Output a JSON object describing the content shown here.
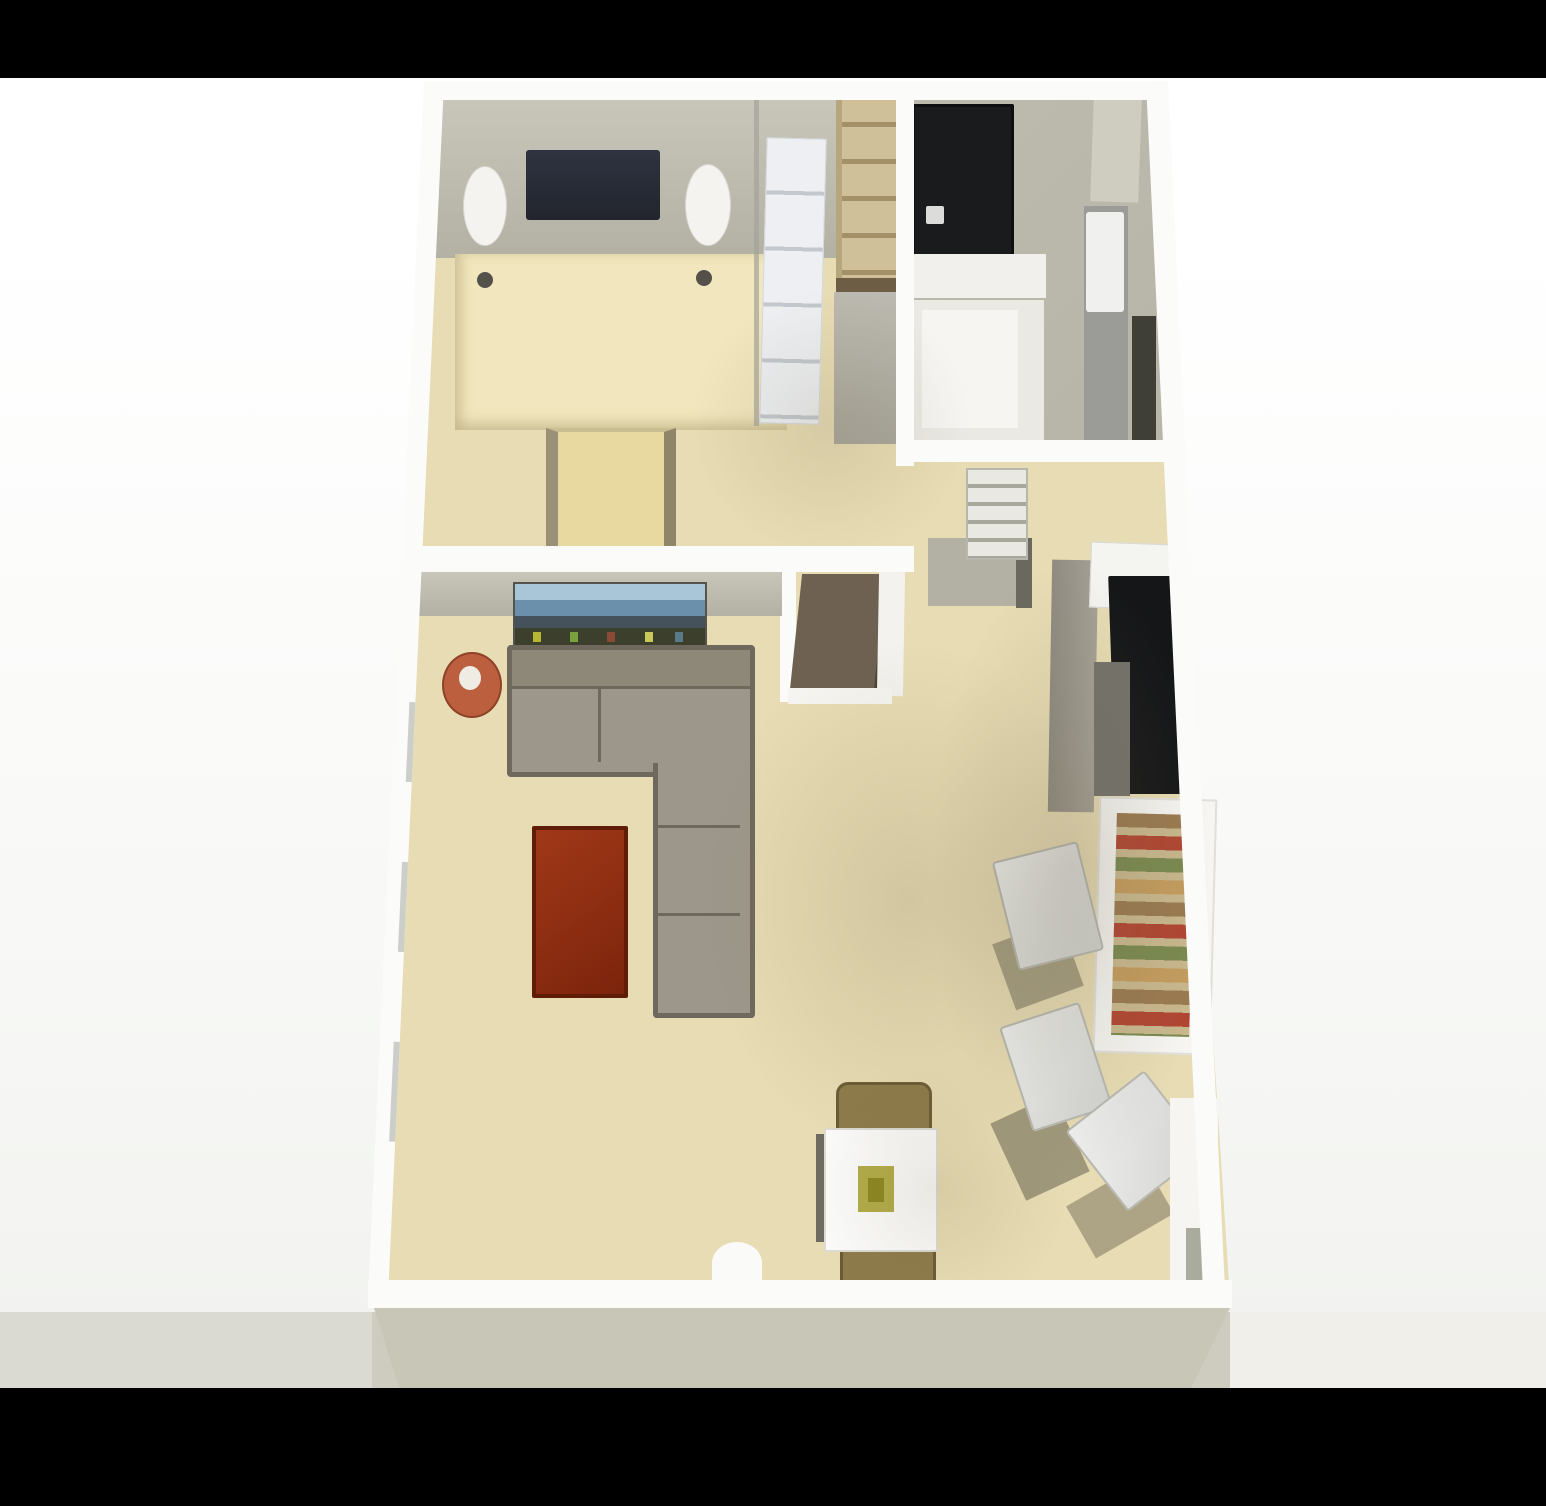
{
  "scene": {
    "type": "3D rendered apartment floor plan, top-down view, letterboxed photo",
    "letterbox": {
      "top_bar": "black",
      "bottom_bar": "black"
    },
    "rooms": [
      {
        "name": "bedroom",
        "position": "top-left",
        "furniture": [
          "bed with dark navy headboard",
          "left white nightstand",
          "right white nightstand",
          "tan bed cover with two dark pillows",
          "bench at foot of bed"
        ]
      },
      {
        "name": "closet",
        "position": "top-center",
        "furniture": [
          "white shelving tower",
          "tan shelf ladder",
          "gray wardrobe panel"
        ]
      },
      {
        "name": "bathroom",
        "position": "top-right",
        "furniture": [
          "black shower with drain",
          "white vanity counter",
          "toilet with white tank",
          "light door",
          "dark cabinet strip"
        ]
      },
      {
        "name": "hallway",
        "position": "center-right",
        "furniture": [
          "white paneled door",
          "entry nook with dark open door"
        ]
      },
      {
        "name": "living-room",
        "position": "bottom-left",
        "furniture": [
          "media console with blue screen",
          "L-shaped gray sectional sofa",
          "round red side table",
          "mahogany coffee table",
          "white dining table with olive centerpiece",
          "two brown dining chairs",
          "white threshold at bottom wall"
        ]
      },
      {
        "name": "kitchen",
        "position": "right",
        "furniture": [
          "black appliance run",
          "gray counter band",
          "white counter top",
          "pantry shelving with colorful supplies",
          "three white chairs with olive shadows",
          "white side doorway"
        ]
      }
    ]
  },
  "palette": {
    "bg": "#ffffff",
    "bar-black": "#000000",
    "floor": "#e8dcb4",
    "floor-bed": "#eee2bc",
    "wall-white": "#fbfbfa",
    "wall-face": "#b3b1a3",
    "wall-face-light": "#c9c7b9",
    "slab": "#c8c6b6",
    "strip-left": "#dbdad2",
    "strip-mid": "#cdccbe",
    "strip-right": "#f0efe9",
    "headboard-dark": "#22252d",
    "nightstand-white": "#f5f3f0",
    "bed-cover": "#f1e6bd",
    "bench-tan": "#e7d99f",
    "shelf-white": "#edeff2",
    "ladder-tan": "#cfc09a",
    "shower-black": "#1a1b1d",
    "fixture-white": "#f1f0ed",
    "toilet-gray": "#9b9b97",
    "sofa-fill": "#9d978b",
    "sofa-line": "#6f685c",
    "tv-blue-top": "#a9c6d9",
    "tv-blue-mid": "#6a90ac",
    "tv-dark": "#3b3f2c",
    "side-table-red": "#bb5f3e",
    "side-table-center": "#efece4",
    "coffee-table": "#8a2c12",
    "coffee-table-dark": "#5f1d08",
    "dining-white": "#fbfbfa",
    "chair-brown": "#8d7a4a",
    "centerpiece-olive": "#b2ab48",
    "appliance-black": "#151618",
    "counter-gray": "#98948a",
    "pantry-frame": "#f6f5f2",
    "pantry-shelf": "#c9b88e",
    "stool-white": "#f0f1f0",
    "shadow-olive": "#6f6b55",
    "nook-dark": "#6e6152",
    "door-light": "#e9e8e3"
  }
}
